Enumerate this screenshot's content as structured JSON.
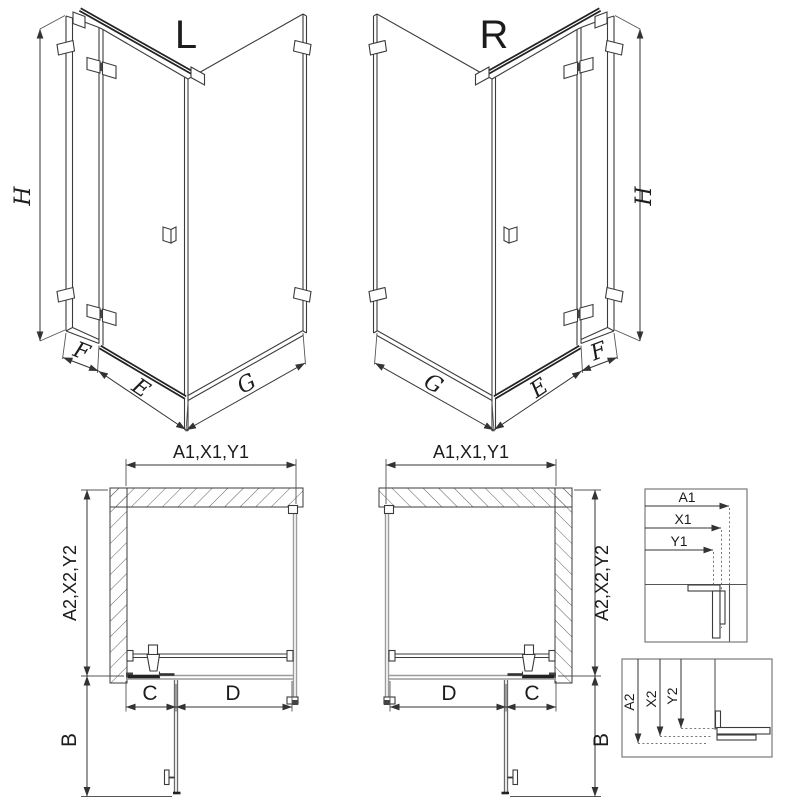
{
  "iso_left": {
    "variant_label": "L",
    "dim_height": "H",
    "dim_side_width": "F",
    "dim_door_width": "E",
    "dim_return_width": "G"
  },
  "iso_right": {
    "variant_label": "R",
    "dim_height": "H",
    "dim_side_width": "F",
    "dim_door_width": "E",
    "dim_return_width": "G"
  },
  "plan_left": {
    "dim_width_combo": "A1,X1,Y1",
    "dim_depth_combo": "A2,X2,Y2",
    "dim_c": "C",
    "dim_d": "D",
    "dim_b": "B"
  },
  "plan_right": {
    "dim_width_combo": "A1,X1,Y1",
    "dim_depth_combo": "A2,X2,Y2",
    "dim_c": "C",
    "dim_d": "D",
    "dim_b": "B"
  },
  "detail_width": {
    "labels": [
      "A1",
      "X1",
      "Y1"
    ]
  },
  "detail_depth": {
    "labels": [
      "A2",
      "X2",
      "Y2"
    ]
  }
}
